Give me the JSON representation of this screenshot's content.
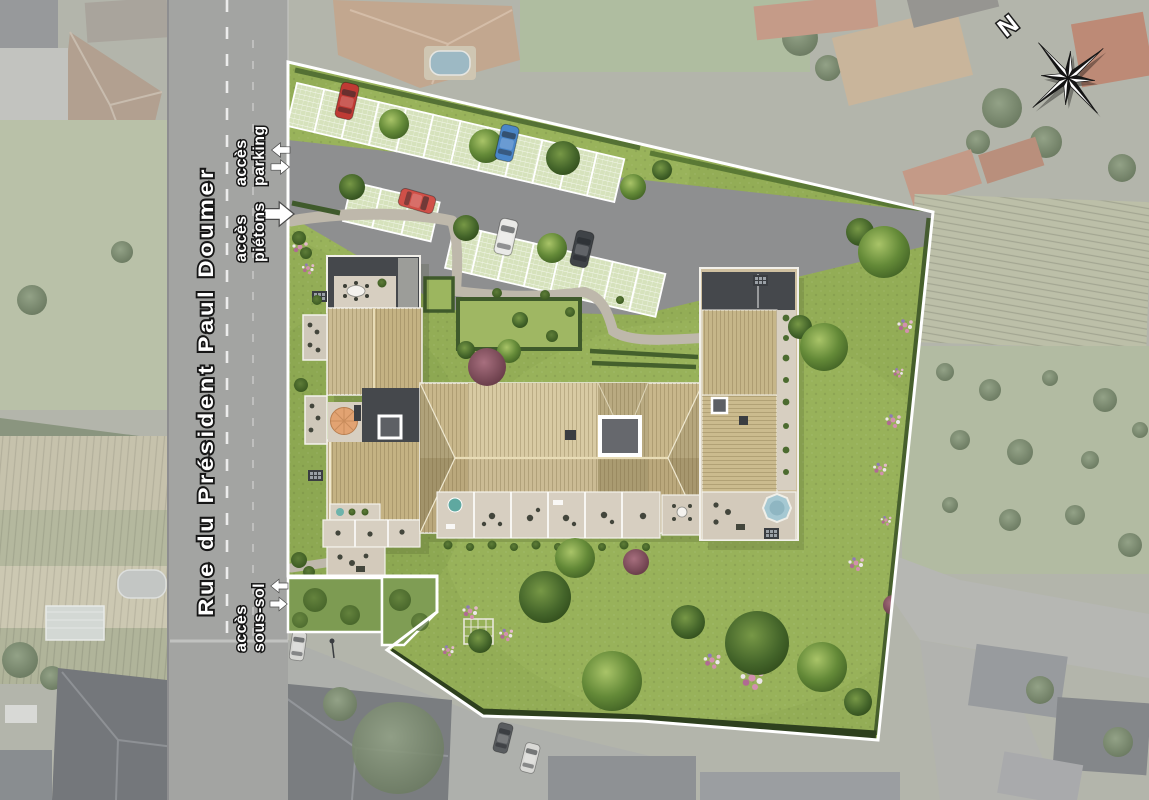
{
  "plan": {
    "street_name": "Rue du Président Paul Doumer",
    "access_points": [
      {
        "id": "parking",
        "line1": "accès",
        "line2": "parking",
        "arrows": [
          "left",
          "right"
        ]
      },
      {
        "id": "pietons",
        "line1": "accès",
        "line2": "piétons",
        "arrows": [
          "right"
        ]
      },
      {
        "id": "sous_sol",
        "line1": "accès",
        "line2": "sous-sol",
        "arrows": [
          "left",
          "right"
        ]
      }
    ],
    "compass": {
      "label": "N",
      "icon": "compass-rose-icon"
    },
    "colors": {
      "site_lawn": "#93ad56",
      "road": "#a3a4a2",
      "parking_asphalt": "#8e8f90",
      "roof_tan": "#c4b283",
      "roof_tan_light": "#d6c69c",
      "roof_dark": "#45484c",
      "terrace": "#d7cfc1",
      "boundary": "#ffffff",
      "hedge": "#3c5526",
      "pool_blue": "#a5c8d2",
      "parasol_orange": "#e2a372",
      "flower_pink": "#d290ae"
    },
    "cars": [
      {
        "color": "#bf3a34",
        "area": "parking-north-row"
      },
      {
        "color": "#4a86c8",
        "area": "parking-north-row"
      },
      {
        "color": "#d05048",
        "area": "parking-mid-stall"
      },
      {
        "color": "#e9e9e7",
        "area": "parking-south-row"
      },
      {
        "color": "#3f4347",
        "area": "parking-south-row"
      }
    ]
  }
}
